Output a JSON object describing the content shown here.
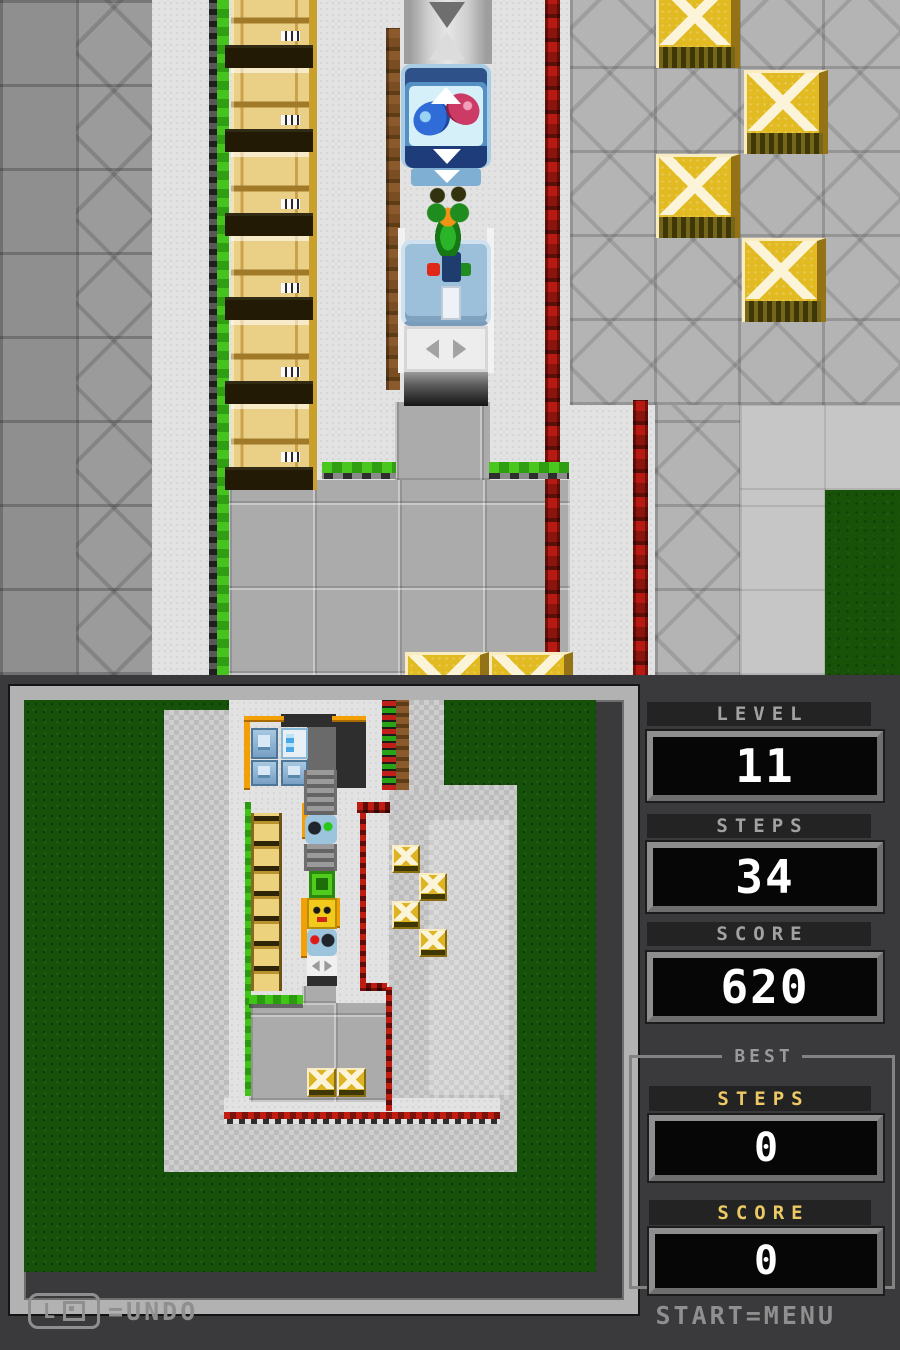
{
  "stats": {
    "level": {
      "label": "LEVEL",
      "value": "11"
    },
    "steps": {
      "label": "STEPS",
      "value": "34"
    },
    "score": {
      "label": "SCORE",
      "value": "620"
    },
    "best": {
      "title": "BEST",
      "steps": {
        "label": "STEPS",
        "value": "0"
      },
      "score": {
        "label": "SCORE",
        "value": "0"
      }
    }
  },
  "hints": {
    "undo_button": "L",
    "undo_text": "=UNDO",
    "menu_text": "START=MENU"
  },
  "colors": {
    "bottom_bg": "#3a3a3c",
    "accent_gold": "#ecc964",
    "grass": "#16510a",
    "wall_green": "#3fc417",
    "wall_red": "#b61a12",
    "crate_gold": "#e2ba22"
  },
  "top_scene": {
    "shapes": [
      {
        "t": "floor-light",
        "x": 0,
        "y": 0,
        "w": 900,
        "h": 675,
        "n": "floor-base"
      },
      {
        "t": "tile-darker",
        "x": 0,
        "y": 0,
        "w": 76,
        "h": 675,
        "n": "tile-wall-left"
      },
      {
        "t": "tile-dark",
        "x": 76,
        "y": 0,
        "w": 76,
        "h": 675,
        "n": "tile-wall-left"
      },
      {
        "t": "tile-mid",
        "x": 570,
        "y": 0,
        "w": 330,
        "h": 405,
        "n": "tile-yard-right"
      },
      {
        "t": "tile-mid",
        "x": 655,
        "y": 405,
        "w": 85,
        "h": 270,
        "n": "tile-yard-right"
      },
      {
        "t": "floor-plain",
        "x": 740,
        "y": 405,
        "w": 160,
        "h": 85
      },
      {
        "t": "floor-plain",
        "x": 740,
        "y": 490,
        "w": 85,
        "h": 185
      },
      {
        "t": "grass",
        "x": 825,
        "y": 490,
        "w": 75,
        "h": 185,
        "n": "grass-patch"
      },
      {
        "t": "floor-court",
        "x": 395,
        "y": 402,
        "w": 95,
        "h": 80,
        "n": "courtyard"
      },
      {
        "t": "floor-court",
        "x": 228,
        "y": 480,
        "w": 342,
        "h": 195,
        "n": "courtyard"
      },
      {
        "t": "wall-green-v",
        "x": 217,
        "y": 0,
        "w": 12,
        "h": 675,
        "n": "green-wall"
      },
      {
        "t": "wall-brown-v",
        "x": 386,
        "y": 28,
        "w": 14,
        "h": 362,
        "n": "brown-wall"
      },
      {
        "t": "wall-red-v",
        "x": 545,
        "y": 0,
        "w": 15,
        "h": 652,
        "n": "red-wall"
      },
      {
        "t": "wall-red-v",
        "x": 633,
        "y": 400,
        "w": 15,
        "h": 275,
        "n": "red-wall"
      },
      {
        "t": "wall-green-h",
        "x": 322,
        "y": 462,
        "w": 74,
        "h": 17,
        "n": "green-wall"
      },
      {
        "t": "wall-green-h",
        "x": 489,
        "y": 462,
        "w": 80,
        "h": 17,
        "n": "green-wall"
      },
      {
        "t": "crate-wood",
        "x": 231,
        "y": -16,
        "w": 86,
        "h": 84,
        "n": "wooden-crate"
      },
      {
        "t": "crate-wood",
        "x": 231,
        "y": 68,
        "w": 86,
        "h": 84,
        "n": "wooden-crate"
      },
      {
        "t": "crate-wood",
        "x": 231,
        "y": 152,
        "w": 86,
        "h": 84,
        "n": "wooden-crate"
      },
      {
        "t": "crate-wood",
        "x": 231,
        "y": 236,
        "w": 86,
        "h": 84,
        "n": "wooden-crate"
      },
      {
        "t": "crate-wood",
        "x": 231,
        "y": 320,
        "w": 86,
        "h": 84,
        "n": "wooden-crate"
      },
      {
        "t": "crate-wood",
        "x": 231,
        "y": 404,
        "w": 86,
        "h": 86,
        "n": "wooden-crate"
      },
      {
        "t": "crate-gold",
        "x": 656,
        "y": -16,
        "w": 84,
        "h": 84,
        "n": "gold-crate"
      },
      {
        "t": "crate-gold",
        "x": 744,
        "y": 70,
        "w": 84,
        "h": 84,
        "n": "gold-crate"
      },
      {
        "t": "crate-gold",
        "x": 656,
        "y": 154,
        "w": 84,
        "h": 84,
        "n": "gold-crate"
      },
      {
        "t": "crate-gold",
        "x": 742,
        "y": 238,
        "w": 84,
        "h": 84,
        "n": "gold-crate"
      },
      {
        "t": "crate-gold",
        "x": 405,
        "y": 652,
        "w": 84,
        "h": 84,
        "n": "gold-crate"
      },
      {
        "t": "crate-gold",
        "x": 489,
        "y": 652,
        "w": 84,
        "h": 84,
        "n": "gold-crate"
      },
      {
        "t": "shaft",
        "x": 404,
        "y": 0,
        "w": 88,
        "h": 64,
        "n": "elevator-shaft"
      },
      {
        "t": "tri-down-gray",
        "x": 429,
        "y": 2,
        "w": 36,
        "h": 26,
        "n": "arrow-down-icon"
      },
      {
        "t": "tri-up-gray",
        "x": 429,
        "y": 32,
        "w": 36,
        "h": 28,
        "n": "arrow-up-icon"
      },
      {
        "t": "edge-light",
        "x": 398,
        "y": 228,
        "w": 7,
        "h": 145
      },
      {
        "t": "edge-light",
        "x": 487,
        "y": 228,
        "w": 7,
        "h": 145
      },
      {
        "t": "tank-frame",
        "x": 401,
        "y": 64,
        "w": 90,
        "h": 104,
        "n": "fish-tank-machine"
      },
      {
        "t": "tank-water",
        "x": 409,
        "y": 86,
        "w": 74,
        "h": 60,
        "n": "fish-tank-water"
      },
      {
        "t": "fish-blue",
        "x": 413,
        "y": 102,
        "w": 37,
        "h": 33,
        "n": "blue-fish"
      },
      {
        "t": "fish-red",
        "x": 446,
        "y": 94,
        "w": 34,
        "h": 30,
        "n": "red-fish"
      },
      {
        "t": "tri-up-white",
        "x": 431,
        "y": 87,
        "w": 30,
        "h": 17,
        "n": "arrow-up-icon"
      },
      {
        "t": "tank-base",
        "x": 405,
        "y": 146,
        "w": 82,
        "h": 22
      },
      {
        "t": "tri-down-white",
        "x": 433,
        "y": 149,
        "w": 28,
        "h": 15,
        "n": "arrow-down-icon"
      },
      {
        "t": "tank-foot",
        "x": 411,
        "y": 168,
        "w": 70,
        "h": 18
      },
      {
        "t": "tri-down-white",
        "x": 434,
        "y": 170,
        "w": 26,
        "h": 13,
        "n": "arrow-down-icon"
      },
      {
        "t": "machine-blue",
        "x": 401,
        "y": 240,
        "w": 90,
        "h": 86,
        "n": "button-machine"
      },
      {
        "t": "dot-red",
        "x": 427,
        "y": 263,
        "w": 13,
        "h": 13,
        "n": "red-button"
      },
      {
        "t": "dot-green",
        "x": 458,
        "y": 263,
        "w": 13,
        "h": 13,
        "n": "green-button"
      },
      {
        "t": "slot-navy",
        "x": 442,
        "y": 252,
        "w": 19,
        "h": 30
      },
      {
        "t": "slot-white",
        "x": 441,
        "y": 286,
        "w": 20,
        "h": 34
      },
      {
        "t": "elevator-white",
        "x": 404,
        "y": 326,
        "w": 84,
        "h": 46,
        "n": "elevator-platform"
      },
      {
        "t": "shaft-dark",
        "x": 404,
        "y": 372,
        "w": 84,
        "h": 34,
        "n": "elevator-shaft"
      },
      {
        "t": "hero",
        "x": 424,
        "y": 184,
        "w": 48,
        "h": 72,
        "n": "player-character"
      }
    ]
  },
  "minimap": {
    "shapes": [
      {
        "t": "floor-check",
        "x": 140,
        "y": 10,
        "w": 66,
        "h": 462
      },
      {
        "t": "floor-light",
        "x": 205,
        "y": 0,
        "w": 200,
        "h": 100
      },
      {
        "t": "floor-light",
        "x": 205,
        "y": 100,
        "w": 160,
        "h": 312
      },
      {
        "t": "floor-check",
        "x": 365,
        "y": 85,
        "w": 128,
        "h": 387
      },
      {
        "t": "floor-light2",
        "x": 405,
        "y": 120,
        "w": 80,
        "h": 275
      },
      {
        "t": "floor-check",
        "x": 140,
        "y": 400,
        "w": 353,
        "h": 72
      },
      {
        "t": "floor-light",
        "x": 200,
        "y": 398,
        "w": 276,
        "h": 14
      },
      {
        "t": "floor-check",
        "x": 385,
        "y": 0,
        "w": 35,
        "h": 90
      },
      {
        "t": "floor-court",
        "x": 225,
        "y": 303,
        "w": 142,
        "h": 99
      },
      {
        "t": "floor-court",
        "x": 278,
        "y": 286,
        "w": 34,
        "h": 19
      },
      {
        "t": "floor-dark",
        "x": 283,
        "y": 27,
        "w": 59,
        "h": 61,
        "n": "room-floor"
      },
      {
        "t": "wall-dark",
        "x": 312,
        "y": 16,
        "w": 30,
        "h": 72
      },
      {
        "t": "wall-dark",
        "x": 257,
        "y": 14,
        "w": 55,
        "h": 13
      },
      {
        "t": "wall-orange",
        "x": 220,
        "y": 16,
        "w": 6,
        "h": 74
      },
      {
        "t": "wall-orange",
        "x": 220,
        "y": 16,
        "w": 40,
        "h": 6
      },
      {
        "t": "wall-orange",
        "x": 308,
        "y": 16,
        "w": 34,
        "h": 6
      },
      {
        "t": "wall-orange",
        "x": 278,
        "y": 103,
        "w": 6,
        "h": 36
      },
      {
        "t": "wall-orange",
        "x": 277,
        "y": 198,
        "w": 6,
        "h": 60
      },
      {
        "t": "wall-orange",
        "x": 310,
        "y": 198,
        "w": 6,
        "h": 30
      },
      {
        "t": "wall-green-vm",
        "x": 221,
        "y": 102,
        "w": 6,
        "h": 294,
        "n": "green-wall"
      },
      {
        "t": "wall-green-hm",
        "x": 225,
        "y": 295,
        "w": 54,
        "h": 9,
        "n": "green-wall"
      },
      {
        "t": "wall-target",
        "x": 358,
        "y": 0,
        "w": 14,
        "h": 90,
        "n": "target-wall"
      },
      {
        "t": "wall-brown-vm",
        "x": 372,
        "y": 0,
        "w": 13,
        "h": 90
      },
      {
        "t": "wall-redm-h",
        "x": 333,
        "y": 102,
        "w": 33,
        "h": 11,
        "n": "red-wall"
      },
      {
        "t": "wall-redm-v",
        "x": 336,
        "y": 112,
        "w": 6,
        "h": 172,
        "n": "red-wall"
      },
      {
        "t": "wall-redm-h",
        "x": 336,
        "y": 283,
        "w": 27,
        "h": 8,
        "n": "red-wall"
      },
      {
        "t": "wall-redm-v",
        "x": 362,
        "y": 287,
        "w": 6,
        "h": 124,
        "n": "red-wall"
      },
      {
        "t": "wall-red-z",
        "x": 200,
        "y": 412,
        "w": 276,
        "h": 12,
        "n": "red-wall"
      },
      {
        "t": "mini-machine",
        "x": 227,
        "y": 28,
        "w": 27,
        "h": 31,
        "n": "machine"
      },
      {
        "t": "mini-fridge",
        "x": 257,
        "y": 28,
        "w": 27,
        "h": 31,
        "n": "fish-tank-machine"
      },
      {
        "t": "mini-machine",
        "x": 227,
        "y": 60,
        "w": 27,
        "h": 26,
        "n": "machine"
      },
      {
        "t": "mini-machine",
        "x": 257,
        "y": 60,
        "w": 27,
        "h": 26,
        "n": "machine"
      },
      {
        "t": "mini-belt",
        "x": 280,
        "y": 70,
        "w": 33,
        "h": 45,
        "n": "conveyor"
      },
      {
        "t": "mini-bot",
        "x": 281,
        "y": 115,
        "w": 32,
        "h": 29,
        "n": "robot-machine"
      },
      {
        "t": "mini-belt",
        "x": 280,
        "y": 144,
        "w": 33,
        "h": 27,
        "n": "conveyor"
      },
      {
        "t": "mini-lift",
        "x": 285,
        "y": 171,
        "w": 26,
        "h": 27,
        "n": "green-elevator"
      },
      {
        "t": "mini-hero",
        "x": 283,
        "y": 198,
        "w": 30,
        "h": 31,
        "n": "minimap-player"
      },
      {
        "t": "mini-bot2",
        "x": 283,
        "y": 229,
        "w": 30,
        "h": 27,
        "n": "robot-machine"
      },
      {
        "t": "mini-elev",
        "x": 283,
        "y": 256,
        "w": 30,
        "h": 20,
        "n": "elevator-platform"
      },
      {
        "t": "wall-dark",
        "x": 283,
        "y": 276,
        "w": 30,
        "h": 10
      },
      {
        "t": "mini-crates",
        "x": 227,
        "y": 113,
        "w": 31,
        "h": 178,
        "n": "wooden-crate-stack"
      },
      {
        "t": "mini-gold",
        "x": 368,
        "y": 145,
        "w": 28,
        "h": 28,
        "n": "gold-crate"
      },
      {
        "t": "mini-gold",
        "x": 395,
        "y": 173,
        "w": 28,
        "h": 28,
        "n": "gold-crate"
      },
      {
        "t": "mini-gold",
        "x": 368,
        "y": 201,
        "w": 28,
        "h": 28,
        "n": "gold-crate"
      },
      {
        "t": "mini-gold",
        "x": 395,
        "y": 229,
        "w": 28,
        "h": 28,
        "n": "gold-crate"
      },
      {
        "t": "mini-gold",
        "x": 283,
        "y": 368,
        "w": 29,
        "h": 29,
        "n": "gold-crate"
      },
      {
        "t": "mini-gold",
        "x": 313,
        "y": 368,
        "w": 29,
        "h": 29,
        "n": "gold-crate"
      }
    ]
  }
}
